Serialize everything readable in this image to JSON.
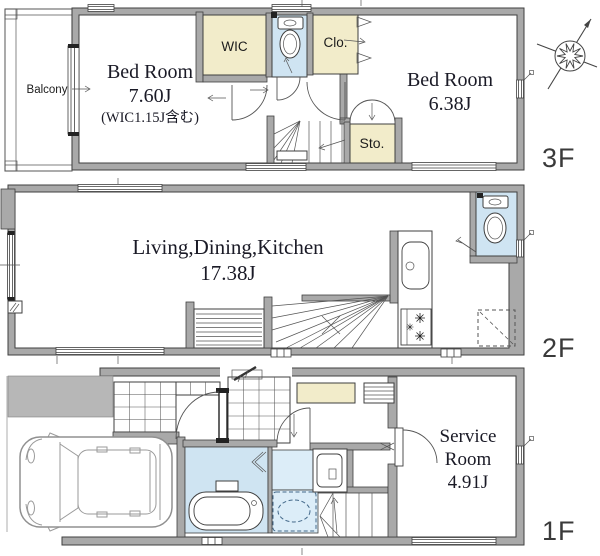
{
  "document": {
    "type": "house-floor-plan",
    "floor_count": 3
  },
  "floors": {
    "f3": {
      "label": "3F",
      "balcony_label": "Balcony",
      "bedroom_left": {
        "name": "Bed Room",
        "size": "7.60J",
        "note": "(WIC1.15J含む)"
      },
      "walk_in_closet_label": "WIC",
      "closet_label": "Clo.",
      "storage_label": "Sto.",
      "bedroom_right": {
        "name": "Bed Room",
        "size": "6.38J"
      }
    },
    "f2": {
      "label": "2F",
      "ldk": {
        "name": "Living,Dining,Kitchen",
        "size": "17.38J"
      }
    },
    "f1": {
      "label": "1F",
      "service_room": {
        "name_line1": "Service",
        "name_line2": "Room",
        "size": "4.91J"
      }
    }
  },
  "colors": {
    "wall_fill": "#a9a9a9",
    "wall_outline": "#3f3f3f",
    "closet_fill": "#f2ecca",
    "wet_fill": "#cfe4f2",
    "wet_fill_light": "#dcedf8",
    "approach_fill": "#b7b7b7",
    "room_text": "#1a1a26",
    "floor_label_text": "#3a3a3a"
  },
  "icons": {
    "compass": "north-arrow-icon",
    "toilet": "toilet-icon",
    "bathtub": "bathtub-icon",
    "car": "car-icon",
    "stove": "gas-stove-icon",
    "kitchen_sink": "kitchen-sink-icon",
    "washbasin": "washbasin-icon",
    "washing_machine": "washing-machine-space-icon",
    "refrigerator": "refrigerator-space-icon",
    "stairs": "stairs-icon"
  }
}
